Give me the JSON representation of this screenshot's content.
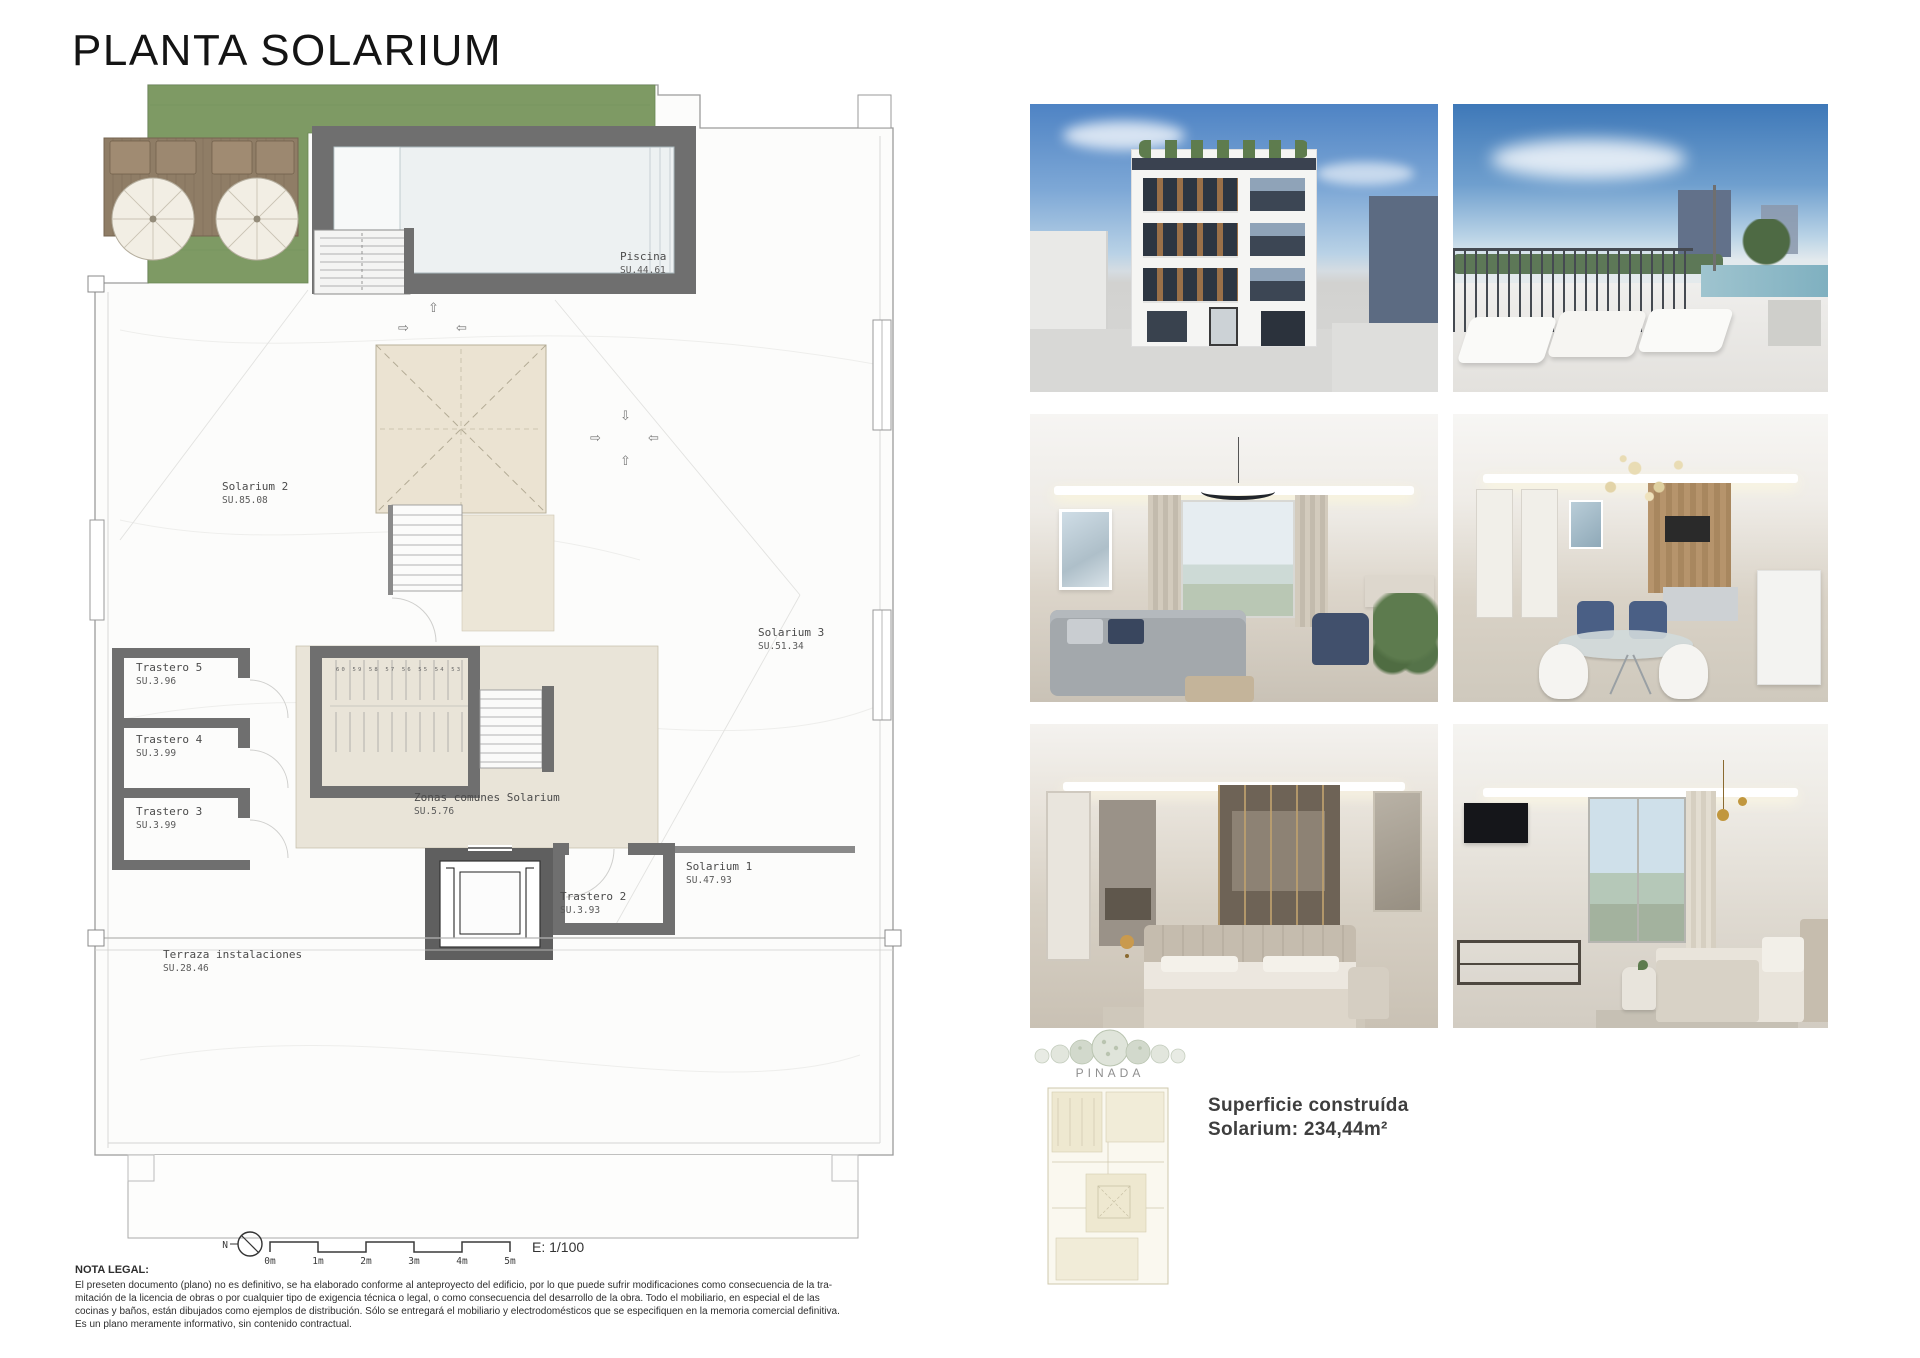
{
  "title": "PLANTA SOLARIUM",
  "plan": {
    "rooms": [
      {
        "name": "Piscina",
        "area": "SU.44.61"
      },
      {
        "name": "Solarium 2",
        "area": "SU.85.08"
      },
      {
        "name": "Solarium 3",
        "area": "SU.51.34"
      },
      {
        "name": "Trastero 5",
        "area": "SU.3.96"
      },
      {
        "name": "Trastero 4",
        "area": "SU.3.99"
      },
      {
        "name": "Trastero 3",
        "area": "SU.3.99"
      },
      {
        "name": "Zonas comunes Solarium",
        "area": "SU.5.76"
      },
      {
        "name": "Trastero 2",
        "area": "SU.3.93"
      },
      {
        "name": "Solarium 1",
        "area": "SU.47.93"
      },
      {
        "name": "Terraza instalaciones",
        "area": "SU.28.46"
      }
    ],
    "stair_numbers": "60 59 58 57 56 55 54 53",
    "compass": "N",
    "scale_ticks": [
      "0m",
      "1m",
      "2m",
      "3m",
      "4m",
      "5m"
    ],
    "scale_label": "E: 1/100"
  },
  "photos": [
    {
      "id": "building-exterior"
    },
    {
      "id": "rooftop-pool-terrace"
    },
    {
      "id": "living-room"
    },
    {
      "id": "dining-kitchen"
    },
    {
      "id": "bedroom-dressing"
    },
    {
      "id": "bedroom-views"
    }
  ],
  "brand": {
    "name": "PINADA"
  },
  "summary": {
    "line1": "Superficie construída",
    "line2": "Solarium: 234,44m²"
  },
  "legal": {
    "heading": "NOTA LEGAL:",
    "lines": [
      "El preseten documento (plano) no es definitivo, se ha elaborado conforme al anteproyecto del edificio, por lo que puede sufrir modificaciones como consecuencia de la tra-",
      "mitación de la licencia de obras o por cualquier tipo de exigencia técnica o legal, o como consecuencia del desarrollo de la obra. Todo el mobiliario, en especial el de las",
      "cocinas y baños, están dibujados como ejemplos de distribución. Sólo se entregará el mobiliario y electrodomésticos que se especifiquen en la memoria comercial definitiva.",
      "Es un plano meramente informativo, sin contenido contractual."
    ]
  },
  "colors": {
    "grass": "#7e9a64",
    "wall": "#6f6f6f",
    "skylight_fill": "#ebe3d2",
    "accent_text": "#3e3e3e"
  }
}
